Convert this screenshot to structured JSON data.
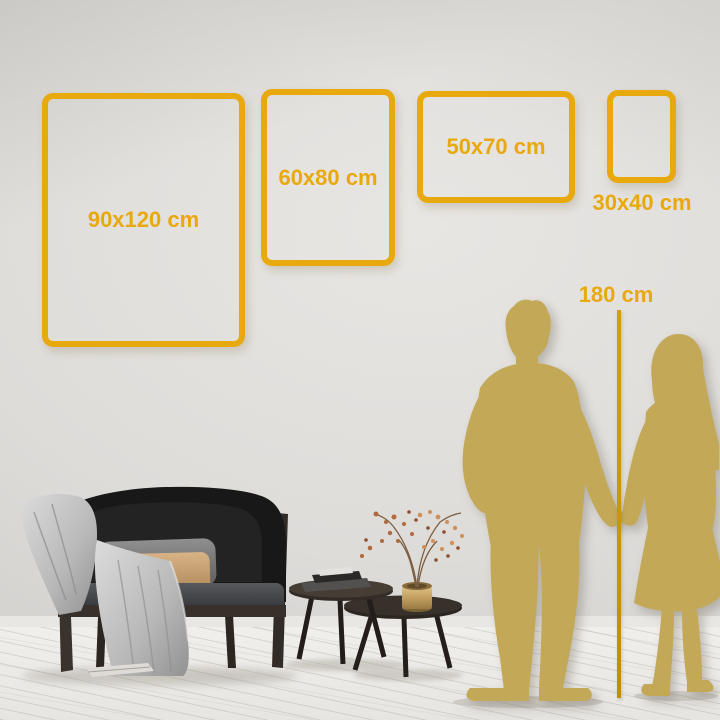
{
  "size_guide": {
    "frames": [
      {
        "label": "90x120 cm",
        "width_cm": 90,
        "height_cm": 120,
        "orientation": "portrait"
      },
      {
        "label": "60x80 cm",
        "width_cm": 60,
        "height_cm": 80,
        "orientation": "portrait"
      },
      {
        "label": "50x70 cm",
        "width_cm": 50,
        "height_cm": 70,
        "orientation": "landscape"
      },
      {
        "label": "30x40 cm",
        "width_cm": 30,
        "height_cm": 40,
        "orientation": "portrait"
      }
    ],
    "reference_height": {
      "label": "180 cm",
      "value_cm": 180
    }
  },
  "colors": {
    "accent_gold": "#E8A90F",
    "line_gold": "#D79D10",
    "silhouette_gold": "#C2A857",
    "wall": "#DEDCD9",
    "floor": "#F1EFEC"
  },
  "scene": {
    "figures": [
      "man-silhouette",
      "woman-silhouette"
    ],
    "furniture": [
      "black-velvet-sofa",
      "gray-throw-blanket",
      "gray-cushion",
      "beige-lumbar-cushion",
      "nesting-coffee-tables",
      "book-stack",
      "brass-vase",
      "dried-flower-branch",
      "book-on-floor"
    ]
  }
}
